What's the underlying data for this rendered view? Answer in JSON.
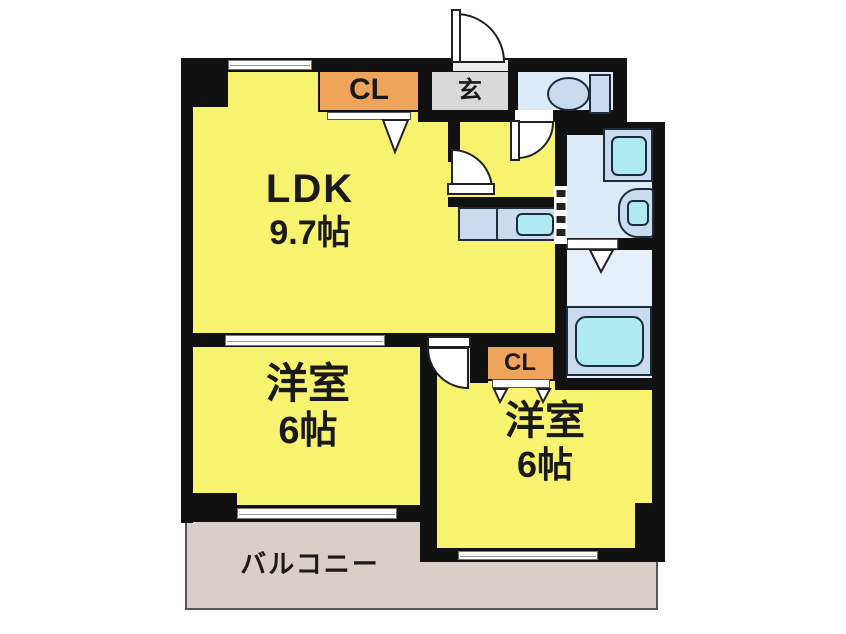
{
  "floorplan": {
    "rooms": {
      "ldk": {
        "name": "LDK",
        "area": "9.7帖"
      },
      "bedroom_left": {
        "name": "洋室",
        "area": "6帖"
      },
      "bedroom_right": {
        "name": "洋室",
        "area": "6帖"
      },
      "balcony": {
        "name": "バルコニー"
      },
      "entrance": {
        "name": "玄"
      },
      "closet_top": {
        "name": "CL"
      },
      "closet_mid": {
        "name": "CL"
      }
    },
    "fixtures": [
      "toilet-icon",
      "washing-machine-icon",
      "sink-icon",
      "bathtub-icon",
      "kitchen-sink-icon"
    ],
    "colors": {
      "wall": "#111111",
      "room_yellow": "#f8f36e",
      "closet_orange": "#efa45b",
      "entrance_gray": "#d9d9d9",
      "wet_room_blue": "#dcebf9",
      "bath_blue": "#e4effa",
      "fixture_blue": "#c9dcef",
      "fixture_cyan": "#aeeaf2",
      "balcony_beige": "#d8cfc8"
    }
  }
}
